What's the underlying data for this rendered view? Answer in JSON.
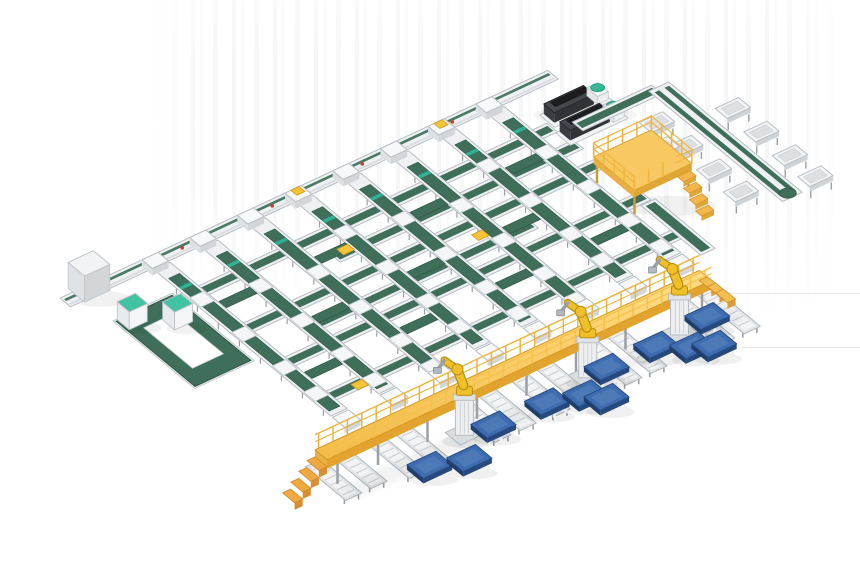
{
  "scene": {
    "type": "isometric-3d-render",
    "subject": "automated conveyor sortation system with robotic palletizing cell",
    "canvas_width": 860,
    "canvas_height": 580,
    "background_color": "#ffffff"
  },
  "palette": {
    "belt_green": "#3f6f5a",
    "belt_green_dark": "#2f5746",
    "belt_green_light": "#4a7a64",
    "frame_white": "#eef0f2",
    "frame_inner": "#f7f8f9",
    "frame_stroke": "#b7bdc3",
    "leg_gray": "#9aa0a5",
    "carriage_white": "#f5f6f7",
    "walkway_yellow": "#f3bb4a",
    "walkway_yellow_light": "#ffdd85",
    "walkway_edge": "#e2a42e",
    "walkway_rail": "#ecb43c",
    "ramp_orange": "#f0a940",
    "ramp_orange_dark": "#d98f2d",
    "robot_yellow": "#f0c02a",
    "robot_outline": "#b78f10",
    "pedestal_gray": "#eceef0",
    "pallet_blue": "#3d6cb0",
    "pallet_blue_dark": "#274a7e",
    "machine_dark": "#45494e",
    "machine_stripe": "#1b1d1f",
    "machine_front": "#303438",
    "pod_teal": "#35b794",
    "cabinet_teal": "#3fc3a2",
    "mezzanine_yellow": "#f8c963",
    "mezzanine_edge": "#d9a62e",
    "mezzanine_rail": "#f1b53e",
    "tray_fill": "#f3f4f5",
    "tray_inner": "#dde0e3",
    "marker_teal": "#2fb393",
    "marker_red": "#d43a2a",
    "item_yellow": "#f6c437",
    "shadow": "rgba(0,0,0,0.055)"
  },
  "iso": {
    "ax": 0.9,
    "ay": -0.42,
    "bx": 0.75,
    "by": 0.62,
    "ox": 162,
    "oy": 266
  },
  "layout": {
    "boundary_conveyor": {
      "u0": -100,
      "u1": 442,
      "v0": -16,
      "v1": -2
    },
    "red_dots_u": [
      -60,
      30,
      130,
      230,
      330
    ],
    "infeed_box": {
      "u": -86,
      "v": -22,
      "w": 28,
      "d": 22,
      "h": 26
    },
    "return_loop": {
      "outer": [
        -80,
        35,
        -18,
        140
      ],
      "inner": [
        -66,
        55,
        -32,
        120
      ]
    },
    "cabinets": [
      {
        "u": -78,
        "v": 34,
        "w": 20,
        "d": 16,
        "h": 18
      },
      {
        "u": -46,
        "v": 56,
        "w": 20,
        "d": 16,
        "h": 18
      }
    ],
    "sorting_lines": {
      "u_positions": [
        0,
        53,
        106,
        159,
        212,
        265,
        318,
        371
      ],
      "v0": 0,
      "v1": 236,
      "belt_v0": 16,
      "belt_v1": 230
    },
    "carriage_vs": [
      46,
      102,
      156,
      198
    ],
    "head_yellow_indices": [
      3,
      6
    ],
    "cross_conveyors": [
      {
        "v": 45,
        "u0": -8,
        "u1": 396
      },
      {
        "v": 75,
        "u0": 130,
        "u1": 400
      },
      {
        "v": 105,
        "u0": -5,
        "u1": 402
      },
      {
        "v": 135,
        "u0": 60,
        "u1": 300
      },
      {
        "v": 160,
        "u0": -2,
        "u1": 404
      },
      {
        "v": 215,
        "u0": 2,
        "u1": 406
      }
    ],
    "merge_belts": [
      [
        0,
        64
      ],
      [
        2,
        64
      ],
      [
        4,
        64
      ],
      [
        6,
        64
      ],
      [
        1,
        124
      ],
      [
        3,
        124
      ],
      [
        5,
        124
      ],
      [
        0,
        178
      ],
      [
        2,
        178
      ],
      [
        4,
        178
      ],
      [
        6,
        178
      ]
    ],
    "carton_items": [
      [
        36,
        216
      ],
      [
        142,
        70
      ],
      [
        250,
        120
      ]
    ],
    "machines": [
      {
        "u": 398,
        "v": 26
      },
      {
        "u": 394,
        "v": 52
      }
    ],
    "mezzanine": {
      "u0": 378,
      "v0": 122,
      "u1": 442,
      "v1": 176,
      "h": 26
    },
    "right_loop": {
      "u0": 496,
      "v0": 54,
      "u1": 518,
      "v1": 232
    },
    "loop_feed": {
      "u0": 415,
      "v0": 49,
      "u1": 503,
      "v1": 63
    },
    "outfeed_link": {
      "u0": 392,
      "v0": 168,
      "u1": 408,
      "v1": 248
    },
    "trays": [
      [
        470,
        96
      ],
      [
        470,
        134
      ],
      [
        470,
        172
      ],
      [
        470,
        208
      ],
      [
        536,
        118
      ],
      [
        536,
        156
      ],
      [
        536,
        194
      ],
      [
        536,
        228
      ],
      [
        452,
        124
      ]
    ],
    "walkway": {
      "u0": -75,
      "u1": 352,
      "v0": 294,
      "v1": 310,
      "h": 30,
      "leg_us": [
        -60,
        -15,
        40,
        95,
        150,
        205,
        260,
        315,
        345
      ],
      "ramp_steps": 4,
      "stair_steps": 3
    },
    "spur_conveyors": [
      [
        -62,
        276,
        330
      ],
      [
        -34,
        276,
        330
      ],
      [
        2,
        276,
        338
      ],
      [
        30,
        276,
        338
      ],
      [
        94,
        276,
        342
      ],
      [
        122,
        276,
        342
      ],
      [
        158,
        276,
        344
      ],
      [
        186,
        276,
        344
      ],
      [
        236,
        276,
        346
      ],
      [
        264,
        276,
        346
      ],
      [
        336,
        276,
        350
      ],
      [
        364,
        276,
        350
      ]
    ],
    "robots": {
      "u_positions": [
        71,
        208,
        310
      ],
      "v": 318
    },
    "pallets": [
      [
        94,
        329
      ],
      [
        14,
        340
      ],
      [
        48,
        352
      ],
      [
        224,
        324
      ],
      [
        152,
        331
      ],
      [
        186,
        341
      ],
      [
        198,
        355
      ],
      [
        339,
        320
      ],
      [
        278,
        325
      ],
      [
        303,
        343
      ],
      [
        320,
        352
      ]
    ],
    "shadow_lines": [
      {
        "x": 700,
        "y": 293,
        "w": 160
      },
      {
        "x": 742,
        "y": 347,
        "w": 118
      },
      {
        "x": 523,
        "y": 399,
        "w": 60
      }
    ]
  }
}
